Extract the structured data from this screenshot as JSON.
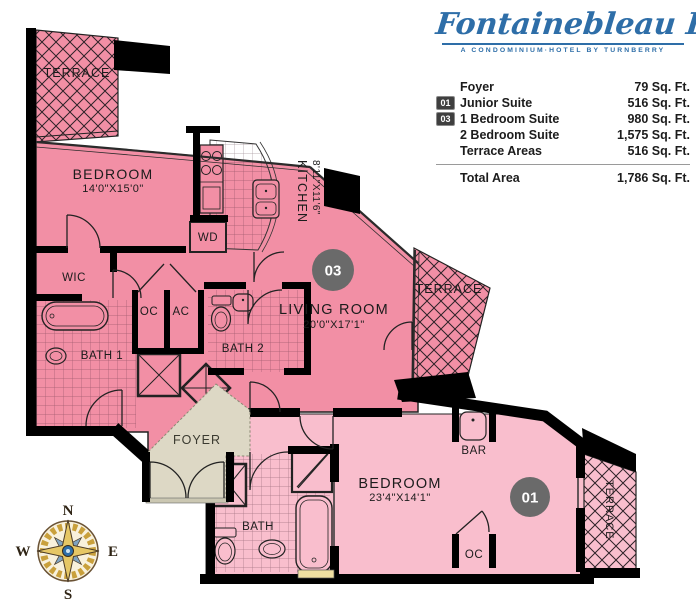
{
  "brand": {
    "name": "Fontainebleau II",
    "tagline": "A CONDOMINIUM·HOTEL BY TURNBERRY"
  },
  "area_table": {
    "rows": [
      {
        "badge": "",
        "label": "Foyer",
        "value": "79 Sq. Ft."
      },
      {
        "badge": "01",
        "label": "Junior Suite",
        "value": "516 Sq. Ft."
      },
      {
        "badge": "03",
        "label": "1 Bedroom Suite",
        "value": "980 Sq. Ft."
      },
      {
        "badge": "",
        "label": "2 Bedroom Suite",
        "value": "1,575 Sq. Ft."
      },
      {
        "badge": "",
        "label": "Terrace Areas",
        "value": "516 Sq. Ft."
      }
    ],
    "total": {
      "label": "Total Area",
      "value": "1,786 Sq. Ft."
    }
  },
  "floorplan": {
    "badges": {
      "junior": "01",
      "one_bedroom": "03"
    },
    "rooms": {
      "terrace_top": "TERRACE",
      "terrace_right": "TERRACE",
      "terrace_bottom": "TERRACE",
      "bedroom_master": {
        "name": "BEDROOM",
        "dims": "14'0\"X15'0\""
      },
      "kitchen": {
        "name": "KITCHEN",
        "dims": "8'11\"X11'6\""
      },
      "living_room": {
        "name": "LIVING ROOM",
        "dims": "20'0\"X17'1\""
      },
      "bedroom_junior": {
        "name": "BEDROOM",
        "dims": "23'4\"X14'1\""
      },
      "wic": "WIC",
      "wd": "WD",
      "oc": "OC",
      "ac": "AC",
      "bath1": "BATH 1",
      "bath2": "BATH 2",
      "bath": "BATH",
      "foyer": "FOYER",
      "bar": "BAR",
      "oc_junior": "OC"
    },
    "compass": {
      "n": "N",
      "e": "E",
      "s": "S",
      "w": "W"
    },
    "colors": {
      "unit_pink": "#F28FA5",
      "junior_pink": "#F9BECD",
      "foyer_beige": "#DDD8C5",
      "wall": "#000000",
      "badge_gray": "#6A6A6A",
      "logo_blue": "#2E6EA8"
    }
  }
}
